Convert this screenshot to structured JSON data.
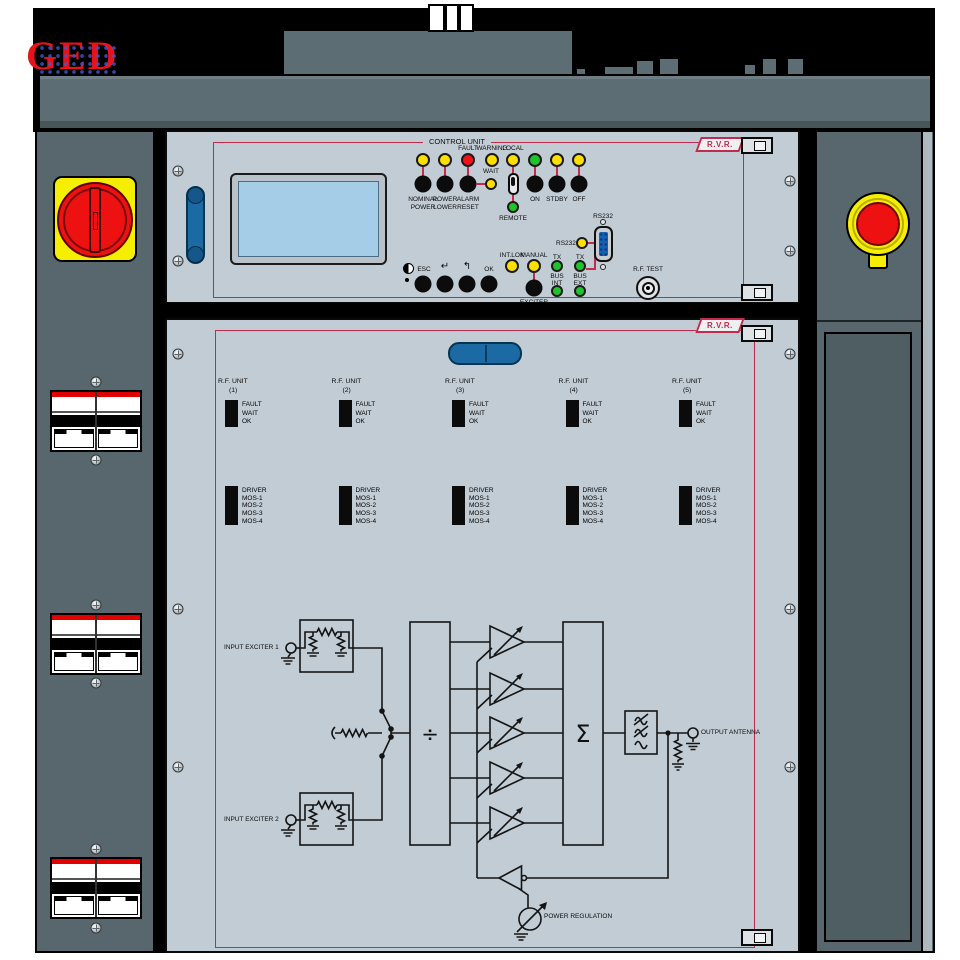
{
  "brand": {
    "ged": "GED",
    "rvr": "R.V.R."
  },
  "control_unit": {
    "title": "CONTROL UNIT",
    "top_leds": {
      "fault": "FAULT",
      "warning": "WARNING",
      "local": "LOCAL"
    },
    "wait": "WAIT",
    "remote": "REMOTE",
    "buttons": {
      "nominal": [
        "NOMINAL",
        "POWER"
      ],
      "lower": [
        "POWER",
        "LOWER"
      ],
      "alarm": [
        "ALARM",
        "RESET"
      ],
      "on": "ON",
      "stdby": "STDBY",
      "off": "OFF"
    },
    "nav": {
      "esc": "ESC",
      "enter": "↵",
      "back": "↰",
      "ok": "OK"
    },
    "changeover": {
      "intlok": "INT.LOK",
      "manual": "MANUAL",
      "caption": [
        "EXCITER",
        "CHANGEOVER"
      ]
    },
    "bus": {
      "tx": "TX",
      "bus": "BUS",
      "int": "INT",
      "ext": "EXT"
    },
    "rs232_led": "RS232",
    "rs232_port": "RS232",
    "rf_test": "R.F. TEST"
  },
  "rf_units": {
    "header": "R.F. UNIT",
    "numbers": [
      "(1)",
      "(2)",
      "(3)",
      "(4)",
      "(5)"
    ],
    "status": [
      "FAULT",
      "WAIT",
      "OK"
    ],
    "driver": [
      "DRIVER",
      "MOS-1",
      "MOS-2",
      "MOS-3",
      "MOS-4"
    ]
  },
  "diagram": {
    "input1": "INPUT EXCITER 1",
    "input2": "INPUT EXCITER 2",
    "output": "OUTPUT ANTENNA",
    "regulation": "POWER REGULATION",
    "divider": "÷",
    "combiner": "Σ"
  },
  "colors": {
    "accent": "#c22a4e",
    "panel": "#c2ccd4",
    "cabinet": "#5c6d73",
    "led_yellow": "#ffdf00",
    "led_red": "#f31018",
    "led_green": "#1fc32b",
    "lcd": "#a6cde8",
    "handle_blue": "#1c6aa3",
    "estop_red": "#ee1111",
    "safety_yellow": "#f6ee00"
  }
}
